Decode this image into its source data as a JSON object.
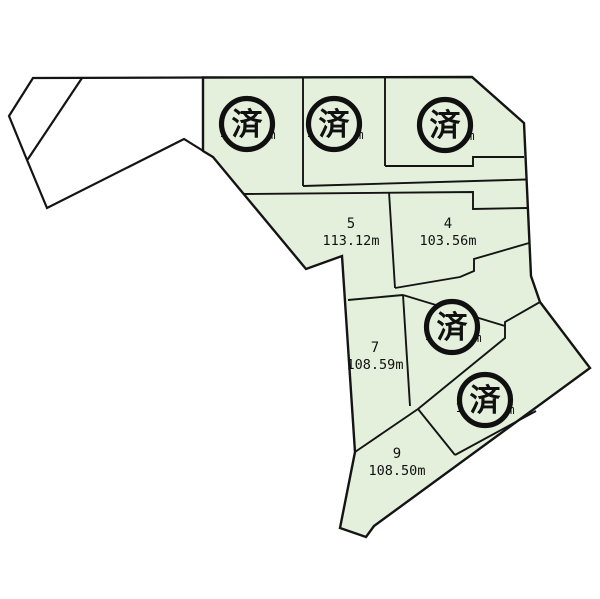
{
  "map": {
    "background_color": "#ffffff",
    "parcel_fill_color": "#e4f0dc",
    "line_color": "#141414",
    "sold_stamp_text": "済",
    "plots": [
      {
        "number": "5",
        "area_label": "113.12m"
      },
      {
        "number": "4",
        "area_label": "103.56m"
      },
      {
        "number": "7",
        "area_label": "108.59m"
      },
      {
        "number": "9",
        "area_label": "108.50m"
      }
    ],
    "sold_stamps": [
      {
        "left_fragment": "1",
        "right_fragment": "m"
      },
      {
        "left_fragment": "1",
        "right_fragment": "m"
      },
      {
        "left_fragment": "",
        "right_fragment": "m"
      },
      {
        "left_fragment": "1",
        "right_fragment": "m"
      },
      {
        "left_fragment": "1",
        "right_fragment": "m"
      }
    ]
  }
}
